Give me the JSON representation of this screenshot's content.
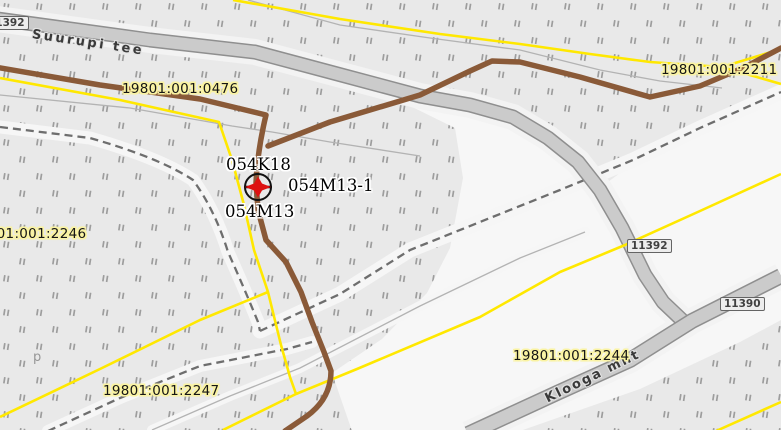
{
  "map": {
    "parcel_labels": {
      "p0476": {
        "text": "19801:001:0476"
      },
      "p2211": {
        "text": "19801:001:2211"
      },
      "p2246": {
        "text": "19801:001:2246"
      },
      "p2247": {
        "text": "19801:001:2247"
      },
      "p2244": {
        "text": "19801:001:2244"
      }
    },
    "utility_labels": {
      "k18": {
        "text": "054K18"
      },
      "m13_1": {
        "text": "054M13-1"
      },
      "m13": {
        "text": "054M13"
      }
    },
    "road_names": {
      "suurupi": {
        "text": "Suurupi tee"
      },
      "klooga": {
        "text": "Klooga mnt"
      }
    },
    "road_numbers": {
      "badge_11392_clipped": {
        "text": "11392"
      },
      "badge_11392": {
        "text": "11392"
      },
      "badge_11390": {
        "text": "11390"
      }
    },
    "symbols": {
      "p_symbol": {
        "text": "p"
      },
      "marker": {
        "name": "utility-node-marker"
      }
    },
    "colors": {
      "background": "#e9e9e9",
      "pale_area": "#f7f7f7",
      "hatch_tick": "#8f8f8f",
      "road_fill": "#cbcbcb",
      "road_casing": "#8f8f8f",
      "parcel_boundary_yellow": "#ffe800",
      "utility_line_brown": "#8a5a38",
      "dashed_boundary_gray": "#6e6e6e",
      "thin_line_gray": "#b3b3b3",
      "label_halo_yellow": "#faf3a2",
      "marker_red": "#dd1111"
    }
  }
}
